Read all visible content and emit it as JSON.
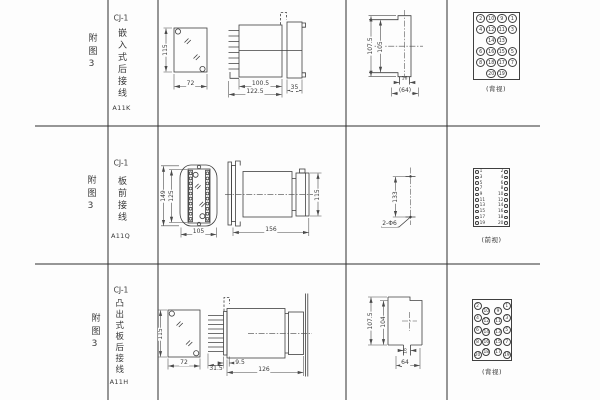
{
  "page": {
    "background": "#fdfdfd",
    "line_color": "#3f3f3f",
    "text_color": "#3a3a3a"
  },
  "rows": [
    {
      "figure_no": "附图3",
      "model": "CJ-1",
      "mounting": "嵌入式后接线",
      "code": "A11K",
      "front_view": {
        "height": "115",
        "width": "72"
      },
      "side_view": {
        "case_length": "100.5",
        "overall_length": "122.5",
        "flange_depth": "35"
      },
      "panel_cutout": {
        "outer_height": "107.5",
        "inner_height": "105",
        "slot_width": "16",
        "overall_width": "(64)"
      },
      "terminal_view": {
        "caption": "(背视)",
        "pin_rows": [
          [
            "2",
            "10",
            "9",
            "1"
          ],
          [
            "4",
            "12",
            "11",
            "3"
          ],
          [
            "",
            "14",
            "13",
            ""
          ],
          [
            "6",
            "16",
            "15",
            "5"
          ],
          [
            "8",
            "18",
            "17",
            "7"
          ],
          [
            "",
            "20",
            "19",
            ""
          ]
        ]
      }
    },
    {
      "figure_no": "附图3",
      "model": "CJ-1",
      "mounting": "板前接线",
      "code": "A11Q",
      "front_view": {
        "outer_height": "149",
        "inner_height": "125",
        "width": "105"
      },
      "side_view": {
        "length": "156",
        "height": "115"
      },
      "drilling": {
        "hole_spacing": "133",
        "hole_callout": "2-Φ6"
      },
      "terminal_view": {
        "caption": "(前视)",
        "pin_pairs": [
          [
            "1",
            "2"
          ],
          [
            "3",
            "4"
          ],
          [
            "5",
            "6"
          ],
          [
            "7",
            "8"
          ],
          [
            "9",
            "10"
          ],
          [
            "11",
            "12"
          ],
          [
            "13",
            "14"
          ],
          [
            "15",
            "16"
          ],
          [
            "17",
            "18"
          ],
          [
            "19",
            "20"
          ]
        ]
      }
    },
    {
      "figure_no": "附图3",
      "model": "CJ-1",
      "mounting": "凸出式板后接线",
      "code": "A11H",
      "front_view": {
        "height": "115",
        "width": "72"
      },
      "side_view": {
        "pin_length": "31.5",
        "board_offset": "9.5",
        "length": "126"
      },
      "panel_cutout": {
        "outer_height": "107.5",
        "inner_height": "104",
        "slot_width": "16",
        "overall_width": "64"
      },
      "terminal_view": {
        "caption": "(背视)",
        "pin_columns": {
          "left_outer": [
            "2",
            "4",
            "6",
            "8",
            "20"
          ],
          "left_inner": [
            "10",
            "12",
            "14",
            "16",
            "18"
          ],
          "right_inner": [
            "9",
            "11",
            "13",
            "15",
            "17"
          ],
          "right_outer": [
            "1",
            "3",
            "5",
            "7",
            "19"
          ]
        }
      }
    }
  ]
}
